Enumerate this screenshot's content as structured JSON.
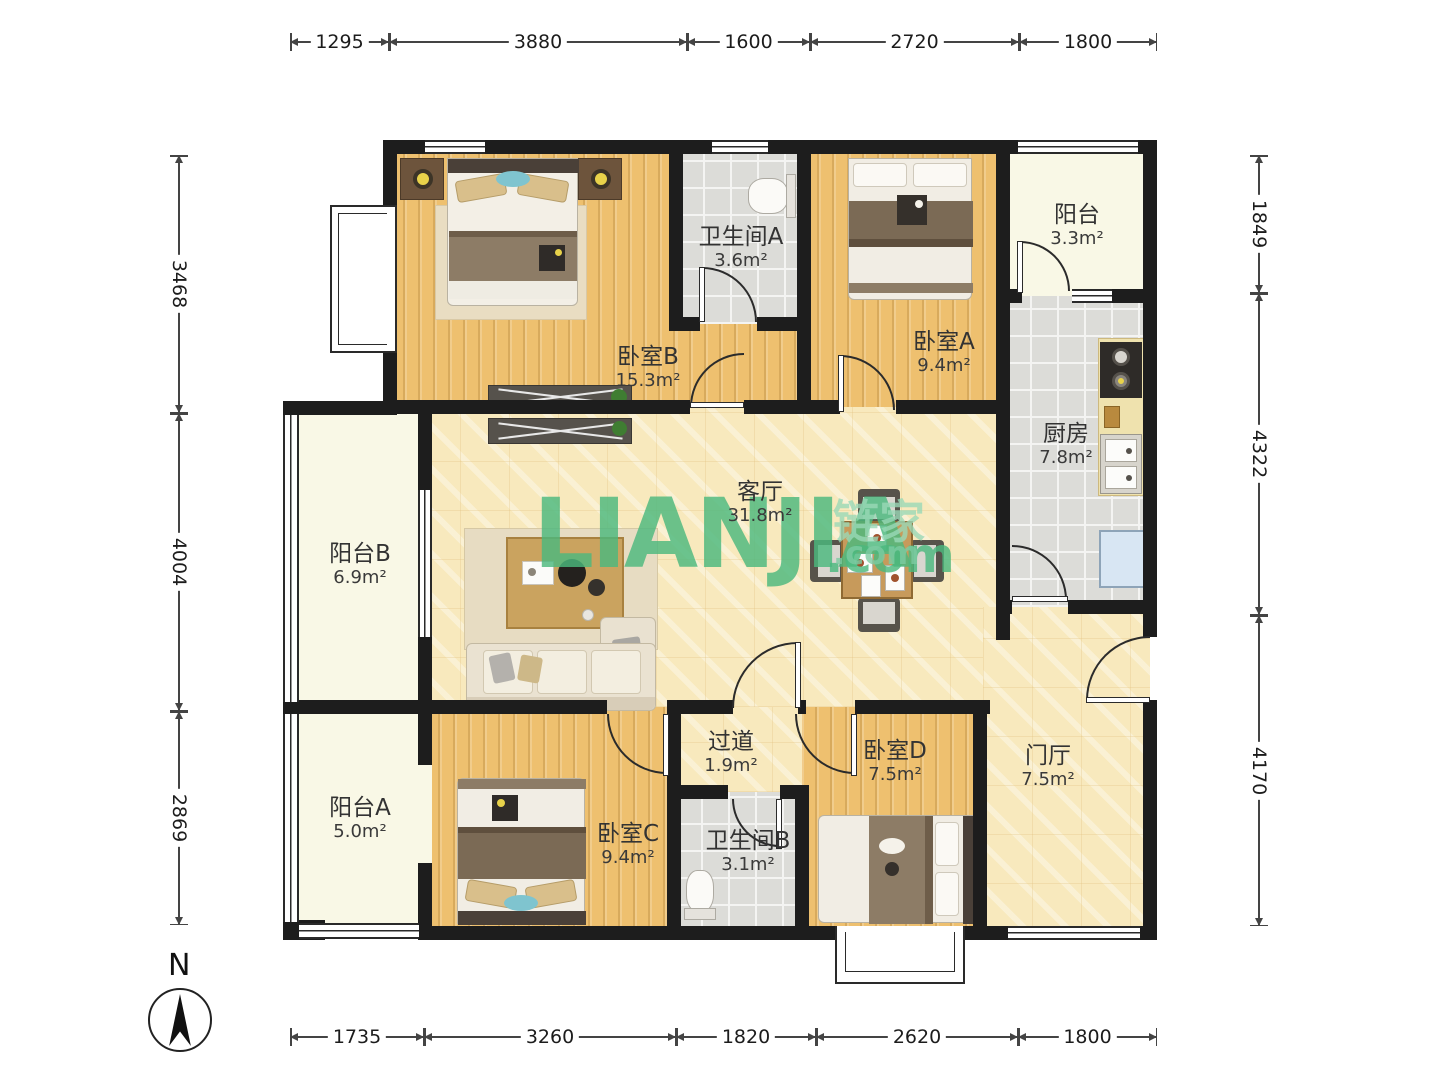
{
  "rooms": [
    {
      "id": "bedroom-b",
      "name": "卧室B",
      "area": "15.3m²"
    },
    {
      "id": "bathroom-a",
      "name": "卫生间A",
      "area": "3.6m²"
    },
    {
      "id": "bedroom-a",
      "name": "卧室A",
      "area": "9.4m²"
    },
    {
      "id": "balcony",
      "name": "阳台",
      "area": "3.3m²"
    },
    {
      "id": "kitchen",
      "name": "厨房",
      "area": "7.8m²"
    },
    {
      "id": "living-room",
      "name": "客厅",
      "area": "31.8m²"
    },
    {
      "id": "balcony-b",
      "name": "阳台B",
      "area": "6.9m²"
    },
    {
      "id": "balcony-a",
      "name": "阳台A",
      "area": "5.0m²"
    },
    {
      "id": "bedroom-c",
      "name": "卧室C",
      "area": "9.4m²"
    },
    {
      "id": "bathroom-b",
      "name": "卫生间B",
      "area": "3.1m²"
    },
    {
      "id": "hallway",
      "name": "过道",
      "area": "1.9m²"
    },
    {
      "id": "bedroom-d",
      "name": "卧室D",
      "area": "7.5m²"
    },
    {
      "id": "foyer",
      "name": "门厅",
      "area": "7.5m²"
    }
  ],
  "dimensions": {
    "top": [
      "1295",
      "3880",
      "1600",
      "2720",
      "1800"
    ],
    "bottom": [
      "1735",
      "3260",
      "1820",
      "2620",
      "1800"
    ],
    "left": [
      "3468",
      "4004",
      "2869"
    ],
    "right": [
      "1849",
      "4322",
      "4170"
    ]
  },
  "compass": {
    "label": "N"
  },
  "watermark": {
    "main": "LIANJIA",
    "suffix": ".com",
    "cn": "链家",
    "cn_suffix": ".com"
  },
  "colors": {
    "wall": "#1d1d1d",
    "wood": "#eec06f",
    "marble": "#f8e9bd",
    "tile": "#dcdcd8",
    "balcony_floor": "#f9f8e6",
    "watermark_green": "#4cb87e"
  }
}
